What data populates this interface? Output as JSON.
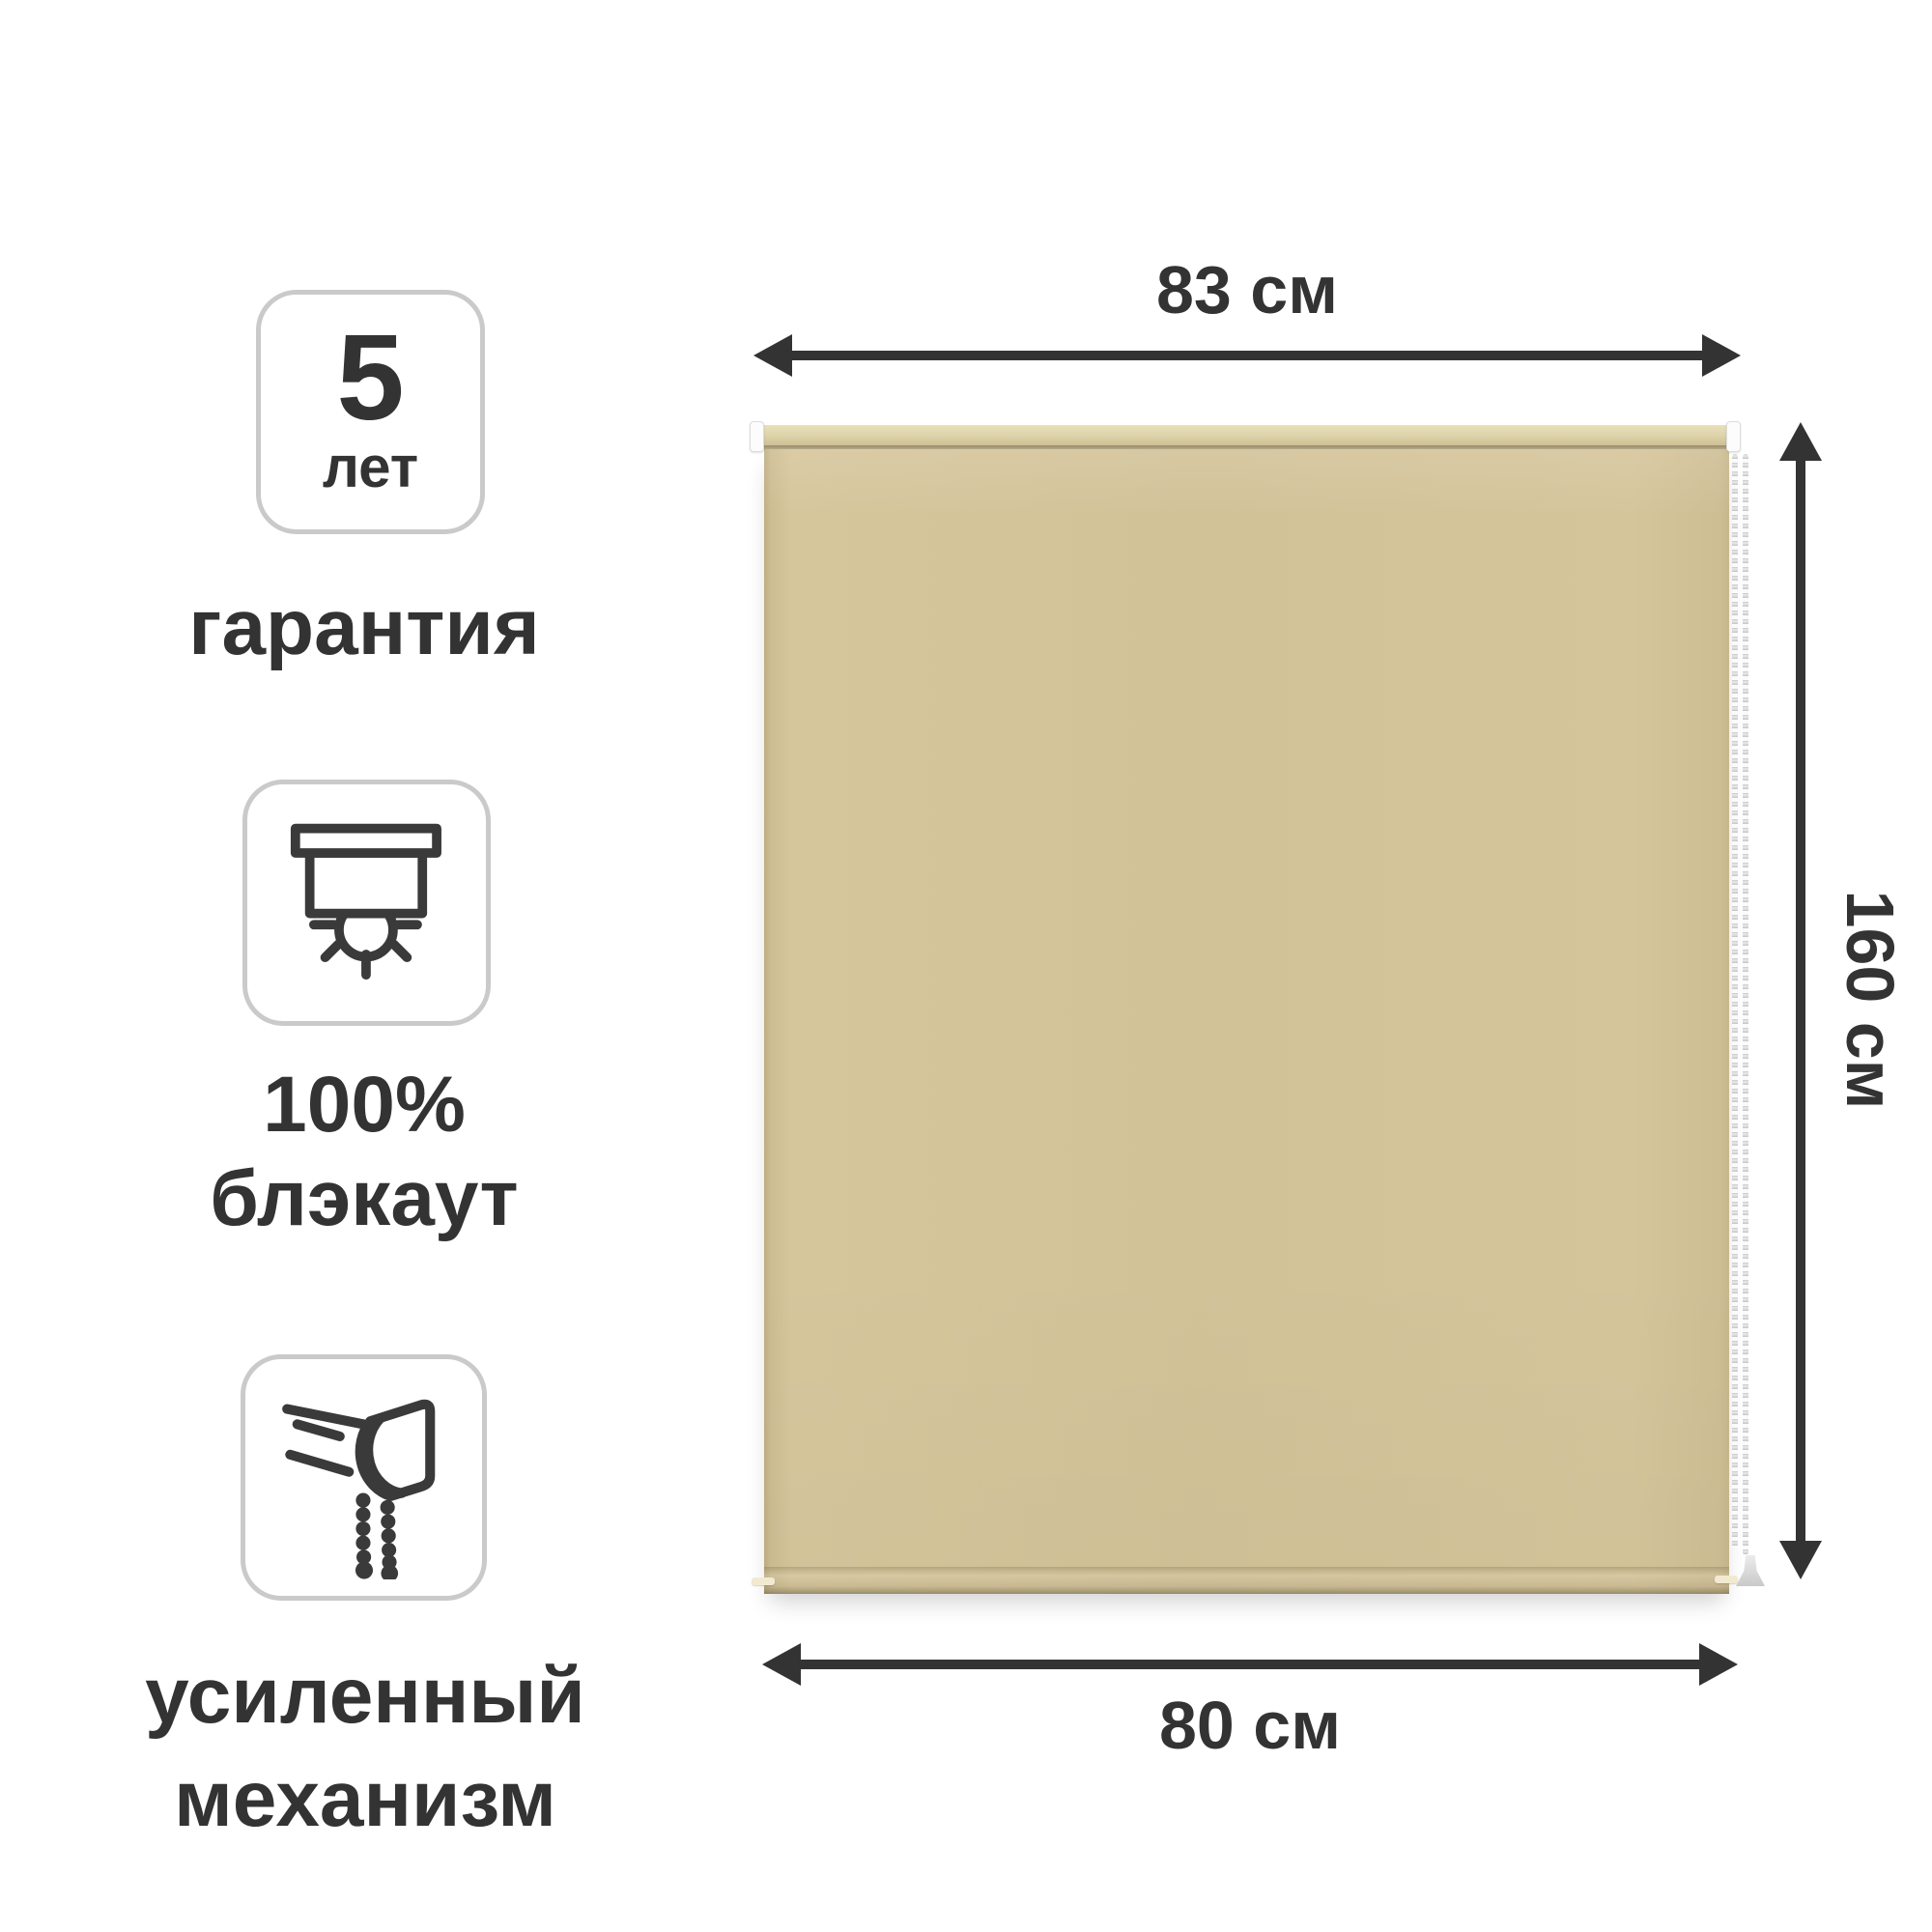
{
  "features": [
    {
      "badge_value": "5",
      "badge_unit": "лет",
      "label": "гарантия"
    },
    {
      "line1": "100%",
      "line2": "блэкаут"
    },
    {
      "line1": "усиленный",
      "line2": "механизм"
    }
  ],
  "dimensions": {
    "width_top": "83 см",
    "height_side": "160 см",
    "width_bottom": "80 см"
  },
  "product": {
    "fabric_color": "#d3c399",
    "tube_color": "#ded3a9",
    "bracket_color": "#ffffff",
    "chain_color": "#d6d6d6"
  },
  "colors": {
    "text": "#333333",
    "arrow": "#333333",
    "icon_stroke": "#3a3a3a",
    "badge_border": "#cacaca",
    "background": "#ffffff"
  }
}
